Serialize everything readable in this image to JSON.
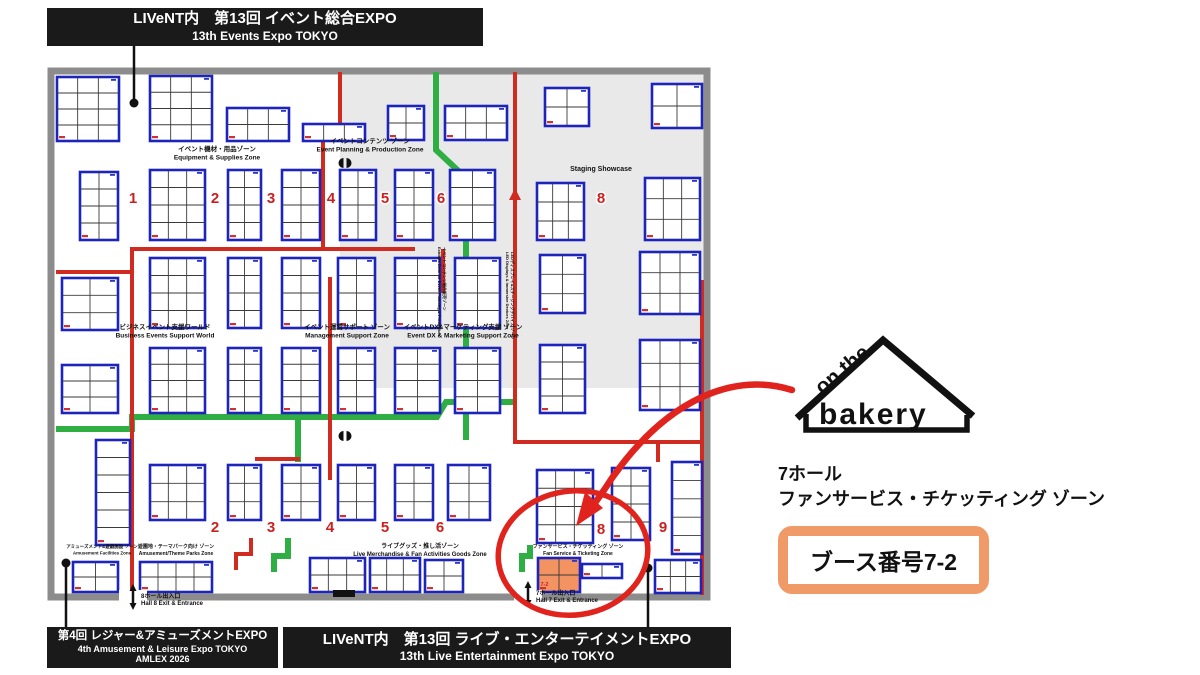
{
  "banners": {
    "top": {
      "line1": "LIVeNT内　第13回 イベント総合EXPO",
      "line2": "13th Events Expo TOKYO"
    },
    "bottom_left": {
      "line1": "第4回 レジャー&アミューズメントEXPO",
      "line2": "4th Amusement & Leisure Expo TOKYO",
      "line3": "AMLEX 2026"
    },
    "bottom_center": {
      "line1": "LIVeNT内　第13回 ライブ・エンターテイメントEXPO",
      "line2": "13th Live Entertainment Expo TOKYO"
    }
  },
  "logo": {
    "top": "on the",
    "main": "bakery"
  },
  "info": {
    "hall": "7ホール",
    "zone": "ファンサービス・チケッティング ゾーン",
    "booth": "ブース番号7-2"
  },
  "colors": {
    "booth_border": "#1d24bb",
    "aisle_red": "#cf2b20",
    "aisle_green": "#2fae44",
    "highlight_orange": "#f29361",
    "panel_orange": "#f09a68",
    "gray_zone": "#e9e9e9",
    "wall_gray": "#8c8c8c",
    "banner_black": "#1a1a1a",
    "number_red": "#cc2020",
    "annotation_red": "#e0231d",
    "ink": "#111111"
  },
  "floorplan": {
    "wall": {
      "x": 51,
      "y": 71,
      "w": 656,
      "h": 526
    },
    "gray_zone": {
      "x": 340,
      "y": 74,
      "w": 364,
      "h": 314
    },
    "stage_block": {
      "x": 333,
      "y": 590,
      "w": 22,
      "h": 7
    },
    "highlight_label": "7-2",
    "staging_label": {
      "text": "Staging Showcase",
      "x": 601,
      "y": 171
    },
    "booths": [
      [
        57,
        77,
        62,
        64,
        3,
        4
      ],
      [
        150,
        76,
        62,
        65,
        3,
        4
      ],
      [
        227,
        108,
        62,
        33,
        3,
        2
      ],
      [
        303,
        124,
        62,
        17,
        3,
        1
      ],
      [
        388,
        106,
        36,
        34,
        2,
        2
      ],
      [
        445,
        106,
        62,
        34,
        3,
        2
      ],
      [
        545,
        88,
        44,
        38,
        2,
        2
      ],
      [
        652,
        84,
        50,
        44,
        2,
        2
      ],
      [
        80,
        172,
        38,
        68,
        2,
        4
      ],
      [
        150,
        170,
        55,
        70,
        3,
        4
      ],
      [
        228,
        170,
        33,
        70,
        2,
        4
      ],
      [
        282,
        170,
        38,
        70,
        2,
        4
      ],
      [
        340,
        170,
        36,
        70,
        2,
        4
      ],
      [
        395,
        170,
        38,
        70,
        2,
        4
      ],
      [
        450,
        170,
        45,
        70,
        2,
        4
      ],
      [
        537,
        183,
        47,
        57,
        3,
        3
      ],
      [
        645,
        178,
        55,
        62,
        3,
        3
      ],
      [
        62,
        278,
        56,
        52,
        2,
        3
      ],
      [
        150,
        258,
        55,
        70,
        3,
        4
      ],
      [
        228,
        258,
        33,
        70,
        2,
        4
      ],
      [
        282,
        258,
        38,
        70,
        2,
        4
      ],
      [
        338,
        258,
        37,
        70,
        2,
        4
      ],
      [
        395,
        258,
        45,
        70,
        2,
        4
      ],
      [
        455,
        258,
        45,
        70,
        2,
        4
      ],
      [
        540,
        255,
        45,
        58,
        2,
        3
      ],
      [
        640,
        252,
        60,
        62,
        3,
        3
      ],
      [
        62,
        365,
        56,
        48,
        2,
        3
      ],
      [
        150,
        348,
        55,
        65,
        3,
        4
      ],
      [
        228,
        348,
        33,
        65,
        2,
        4
      ],
      [
        282,
        348,
        38,
        65,
        2,
        4
      ],
      [
        338,
        348,
        37,
        65,
        2,
        4
      ],
      [
        395,
        348,
        45,
        65,
        2,
        4
      ],
      [
        455,
        348,
        45,
        65,
        2,
        4
      ],
      [
        540,
        345,
        45,
        68,
        2,
        4
      ],
      [
        640,
        340,
        60,
        70,
        3,
        3
      ],
      [
        96,
        440,
        34,
        105,
        1,
        6
      ],
      [
        150,
        465,
        55,
        55,
        3,
        3
      ],
      [
        228,
        465,
        33,
        55,
        2,
        3
      ],
      [
        282,
        465,
        38,
        55,
        2,
        3
      ],
      [
        338,
        465,
        37,
        55,
        2,
        3
      ],
      [
        395,
        465,
        38,
        55,
        2,
        3
      ],
      [
        448,
        465,
        42,
        55,
        2,
        3
      ],
      [
        537,
        470,
        56,
        73,
        3,
        4
      ],
      [
        612,
        468,
        38,
        72,
        2,
        4
      ],
      [
        672,
        462,
        30,
        92,
        1,
        5
      ],
      [
        73,
        562,
        45,
        30,
        2,
        2
      ],
      [
        140,
        562,
        72,
        30,
        4,
        2
      ],
      [
        310,
        558,
        55,
        34,
        3,
        2
      ],
      [
        370,
        558,
        50,
        34,
        3,
        2
      ],
      [
        425,
        560,
        38,
        32,
        2,
        2
      ],
      [
        538,
        558,
        42,
        34,
        2,
        2,
        1
      ],
      [
        582,
        564,
        40,
        14,
        2,
        1
      ],
      [
        655,
        560,
        46,
        33,
        3,
        2
      ]
    ],
    "zone_numbers": [
      [
        "1",
        133,
        203
      ],
      [
        "2",
        215,
        203
      ],
      [
        "3",
        271,
        203
      ],
      [
        "4",
        331,
        203
      ],
      [
        "5",
        385,
        203
      ],
      [
        "6",
        441,
        203
      ],
      [
        "8",
        601,
        203
      ],
      [
        "2",
        215,
        532
      ],
      [
        "3",
        271,
        532
      ],
      [
        "4",
        330,
        532
      ],
      [
        "5",
        385,
        532
      ],
      [
        "6",
        440,
        532
      ],
      [
        "8",
        601,
        534
      ],
      [
        "9",
        663,
        532
      ]
    ],
    "zone_labels": [
      {
        "jp": "イベント機材・用品ゾーン",
        "en": "Equipment & Supplies Zone",
        "x": 217,
        "y": 151,
        "s": 6.5
      },
      {
        "jp": "イベントコンテンツ ゾーン",
        "en": "Event Planning & Production Zone",
        "x": 370,
        "y": 143,
        "s": 6.5
      },
      {
        "jp": "ビジネスイベント支援ワールド",
        "en": "Business Events Support World",
        "x": 165,
        "y": 329,
        "s": 6.5
      },
      {
        "jp": "イベント運営サポート ゾーン",
        "en": "Management Support Zone",
        "x": 347,
        "y": 329,
        "s": 6.5
      },
      {
        "jp": "イベントDX&マーケティング支援 ゾーン",
        "en": "Event DX & Marketing Support Zone",
        "x": 463,
        "y": 329,
        "s": 6.5
      },
      {
        "jp": "アミューズメント&遊戯施設 ゾーン",
        "en": "Amusement Facilities Zone",
        "x": 102,
        "y": 548,
        "s": 4.5
      },
      {
        "jp": "遊園地・テーマパーク向け ゾーン",
        "en": "Amusement/Theme Parks Zone",
        "x": 176,
        "y": 548,
        "s": 5
      },
      {
        "jp": "ライブグッズ・推し活ゾーン",
        "en": "Live Merchandise & Fan Activities Goods Zone",
        "x": 420,
        "y": 548,
        "s": 6
      },
      {
        "jp": "ファンサービス・チケッティング ゾーン",
        "en": "Fan Service & Ticketing Zone",
        "x": 578,
        "y": 548,
        "s": 5
      }
    ],
    "vertical_labels": [
      {
        "jp": "イベントコンテンツ制作販売ゾーン",
        "en": "Exhibits Zone for Event Planning & Production",
        "x": 443,
        "y": 247
      },
      {
        "jp": "LEDディスプレイ&ステージングデバイス ゾーン",
        "en": "LED Displays & Immersive Devices Zone",
        "x": 511,
        "y": 252
      }
    ],
    "exits": [
      {
        "jp": "8ホール出入口",
        "en": "Hall 8 Exit & Entrance",
        "x": 133,
        "label_x": 141,
        "y": 588
      },
      {
        "jp": "7ホール出入口",
        "en": "Hall 7 Exit & Entrance",
        "x": 528,
        "label_x": 536,
        "y": 585
      }
    ],
    "red_paths": [
      [
        [
          340,
          72
        ],
        [
          340,
          125
        ],
        [
          323,
          125
        ],
        [
          323,
          250
        ]
      ],
      [
        [
          56,
          272
        ],
        [
          132,
          272
        ],
        [
          132,
          249
        ],
        [
          415,
          249
        ]
      ],
      [
        [
          443,
          249
        ],
        [
          443,
          293
        ]
      ],
      [
        [
          132,
          249
        ],
        [
          132,
          597
        ]
      ],
      [
        [
          330,
          277
        ],
        [
          330,
          480
        ]
      ],
      [
        [
          255,
          459
        ],
        [
          300,
          459
        ]
      ],
      [
        [
          515,
          72
        ],
        [
          515,
          442
        ],
        [
          702,
          442
        ]
      ],
      [
        [
          702,
          280
        ],
        [
          702,
          595
        ]
      ],
      [
        [
          658,
          442
        ],
        [
          658,
          462
        ]
      ],
      [
        [
          236,
          570
        ],
        [
          236,
          554
        ],
        [
          251,
          554
        ],
        [
          251,
          538
        ]
      ],
      [
        [
          56,
          138
        ],
        [
          96,
          138
        ]
      ]
    ],
    "red_arrowheads": [
      [
        [
          515,
          188
        ],
        [
          509,
          200
        ],
        [
          521,
          200
        ]
      ]
    ],
    "green_paths": [
      [
        [
          436,
          72
        ],
        [
          436,
          150
        ],
        [
          466,
          178
        ],
        [
          466,
          440
        ]
      ],
      [
        [
          56,
          429
        ],
        [
          132,
          429
        ],
        [
          132,
          417
        ],
        [
          437,
          417
        ],
        [
          446,
          402
        ],
        [
          515,
          402
        ]
      ],
      [
        [
          298,
          417
        ],
        [
          298,
          462
        ]
      ],
      [
        [
          288,
          538
        ],
        [
          288,
          556
        ],
        [
          274,
          556
        ],
        [
          274,
          572
        ]
      ],
      [
        [
          530,
          545
        ],
        [
          530,
          556
        ],
        [
          522,
          556
        ],
        [
          522,
          572
        ]
      ]
    ],
    "pillars": [
      [
        345,
        163
      ],
      [
        345,
        436
      ]
    ],
    "connectors": [
      {
        "x": 134,
        "y1": 46,
        "y2": 103,
        "dot": "end"
      },
      {
        "x": 66,
        "y1": 563,
        "y2": 630,
        "dot": "start"
      },
      {
        "x": 648,
        "y1": 568,
        "y2": 628,
        "dot": "start"
      }
    ],
    "circle": {
      "cx": 573,
      "cy": 553,
      "rx": 75,
      "ry": 62,
      "rot": -8
    },
    "arrow": {
      "path": "M 792,390 C 735,372 668,398 612,478 C 603,492 596,502 588,512",
      "echo": "M 620,470 C 606,488 598,500 591,513",
      "head": [
        [
          576,
          526
        ],
        [
          603,
          508
        ],
        [
          585,
          492
        ]
      ]
    }
  }
}
